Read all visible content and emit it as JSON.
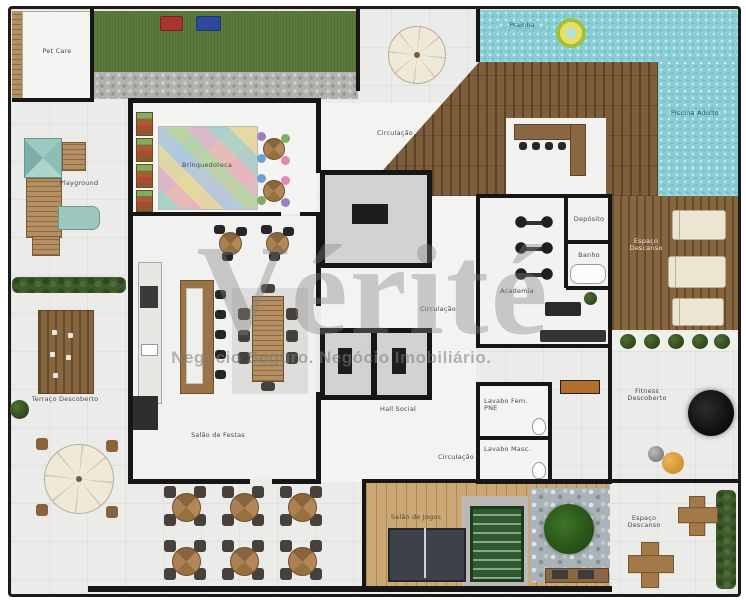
{
  "watermark": {
    "brand": "Vérité",
    "tagline": "Negócio Seguro. Negócio Imobiliário."
  },
  "labels": {
    "pet_care": "Pet Care",
    "playground": "Playground",
    "brinquedoteca": "Brinquedoteca",
    "circulacao_norte": "Circulação",
    "prainha": "Prainha",
    "piscina_adulto": "Piscina Adulto",
    "academia": "Academia",
    "deposito": "Depósito",
    "banho": "Banho",
    "espaco_descanso_deck": "Espaço Descanso",
    "fitness_descoberto": "Fitness Descoberto",
    "espaco_descanso_sul": "Espaço Descanso",
    "salao_de_jogos": "Salão de Jogos",
    "lavabo_fem": "Lavabo Fem. PNE",
    "lavabo_masc": "Lavabo Masc.",
    "hall_social": "Hall Social",
    "circulacao_centro": "Circulação",
    "circulacao_sul": "Circulação",
    "salao_de_festas": "Salão de Festas",
    "terraco_descoberto": "Terraço Descoberto"
  },
  "colors": {
    "pool": "#88ced4",
    "lawn": "#5a7a3c",
    "deck_wood": "#7e5d3a",
    "games_wood": "#cba874",
    "wall": "#161616",
    "floor": "#ebebe9",
    "watermark_gray": "#808080"
  }
}
